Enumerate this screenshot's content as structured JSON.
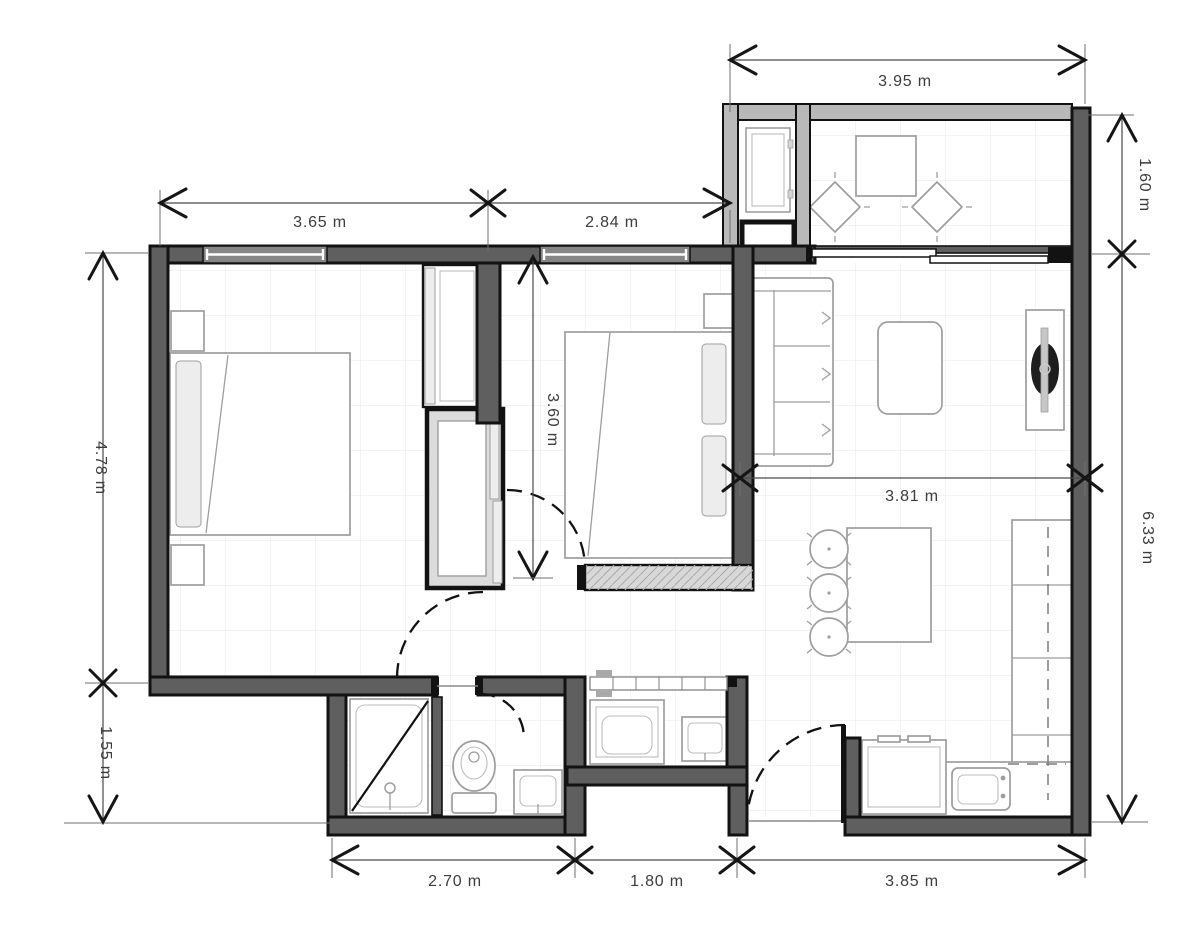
{
  "plan": {
    "type": "apartment-floor-plan",
    "unit": "m"
  },
  "colors": {
    "wall": "#5f5f5f",
    "wall_light": "#b9b9b9",
    "wall_hatched": "#d8d8d8",
    "outline": "#121212",
    "furniture": "#9e9e9e",
    "dimension": "#3d3d3d",
    "grid": "#ececec",
    "floor": "#ffffff",
    "tv_screen": "#1e1e1e",
    "closet_fill": "#dcdcdc"
  },
  "dimensions": {
    "balcony_width": {
      "label": "3.95 m",
      "orientation": "horizontal"
    },
    "bedroom1_width": {
      "label": "3.65 m",
      "orientation": "horizontal"
    },
    "bedroom2_width": {
      "label": "2.84 m",
      "orientation": "horizontal"
    },
    "balcony_depth": {
      "label": "1.60 m",
      "orientation": "vertical"
    },
    "right_side_height": {
      "label": "6.33 m",
      "orientation": "vertical"
    },
    "left_upper_height": {
      "label": "4.78 m",
      "orientation": "vertical"
    },
    "left_lower_height": {
      "label": "1.55 m",
      "orientation": "vertical"
    },
    "bedroom2_depth": {
      "label": "3.60 m",
      "orientation": "vertical"
    },
    "living_width": {
      "label": "3.81 m",
      "orientation": "horizontal"
    },
    "bathroom_width": {
      "label": "2.70 m",
      "orientation": "horizontal"
    },
    "laundry_width": {
      "label": "1.80 m",
      "orientation": "horizontal"
    },
    "kitchen_width": {
      "label": "3.85 m",
      "orientation": "horizontal"
    }
  }
}
